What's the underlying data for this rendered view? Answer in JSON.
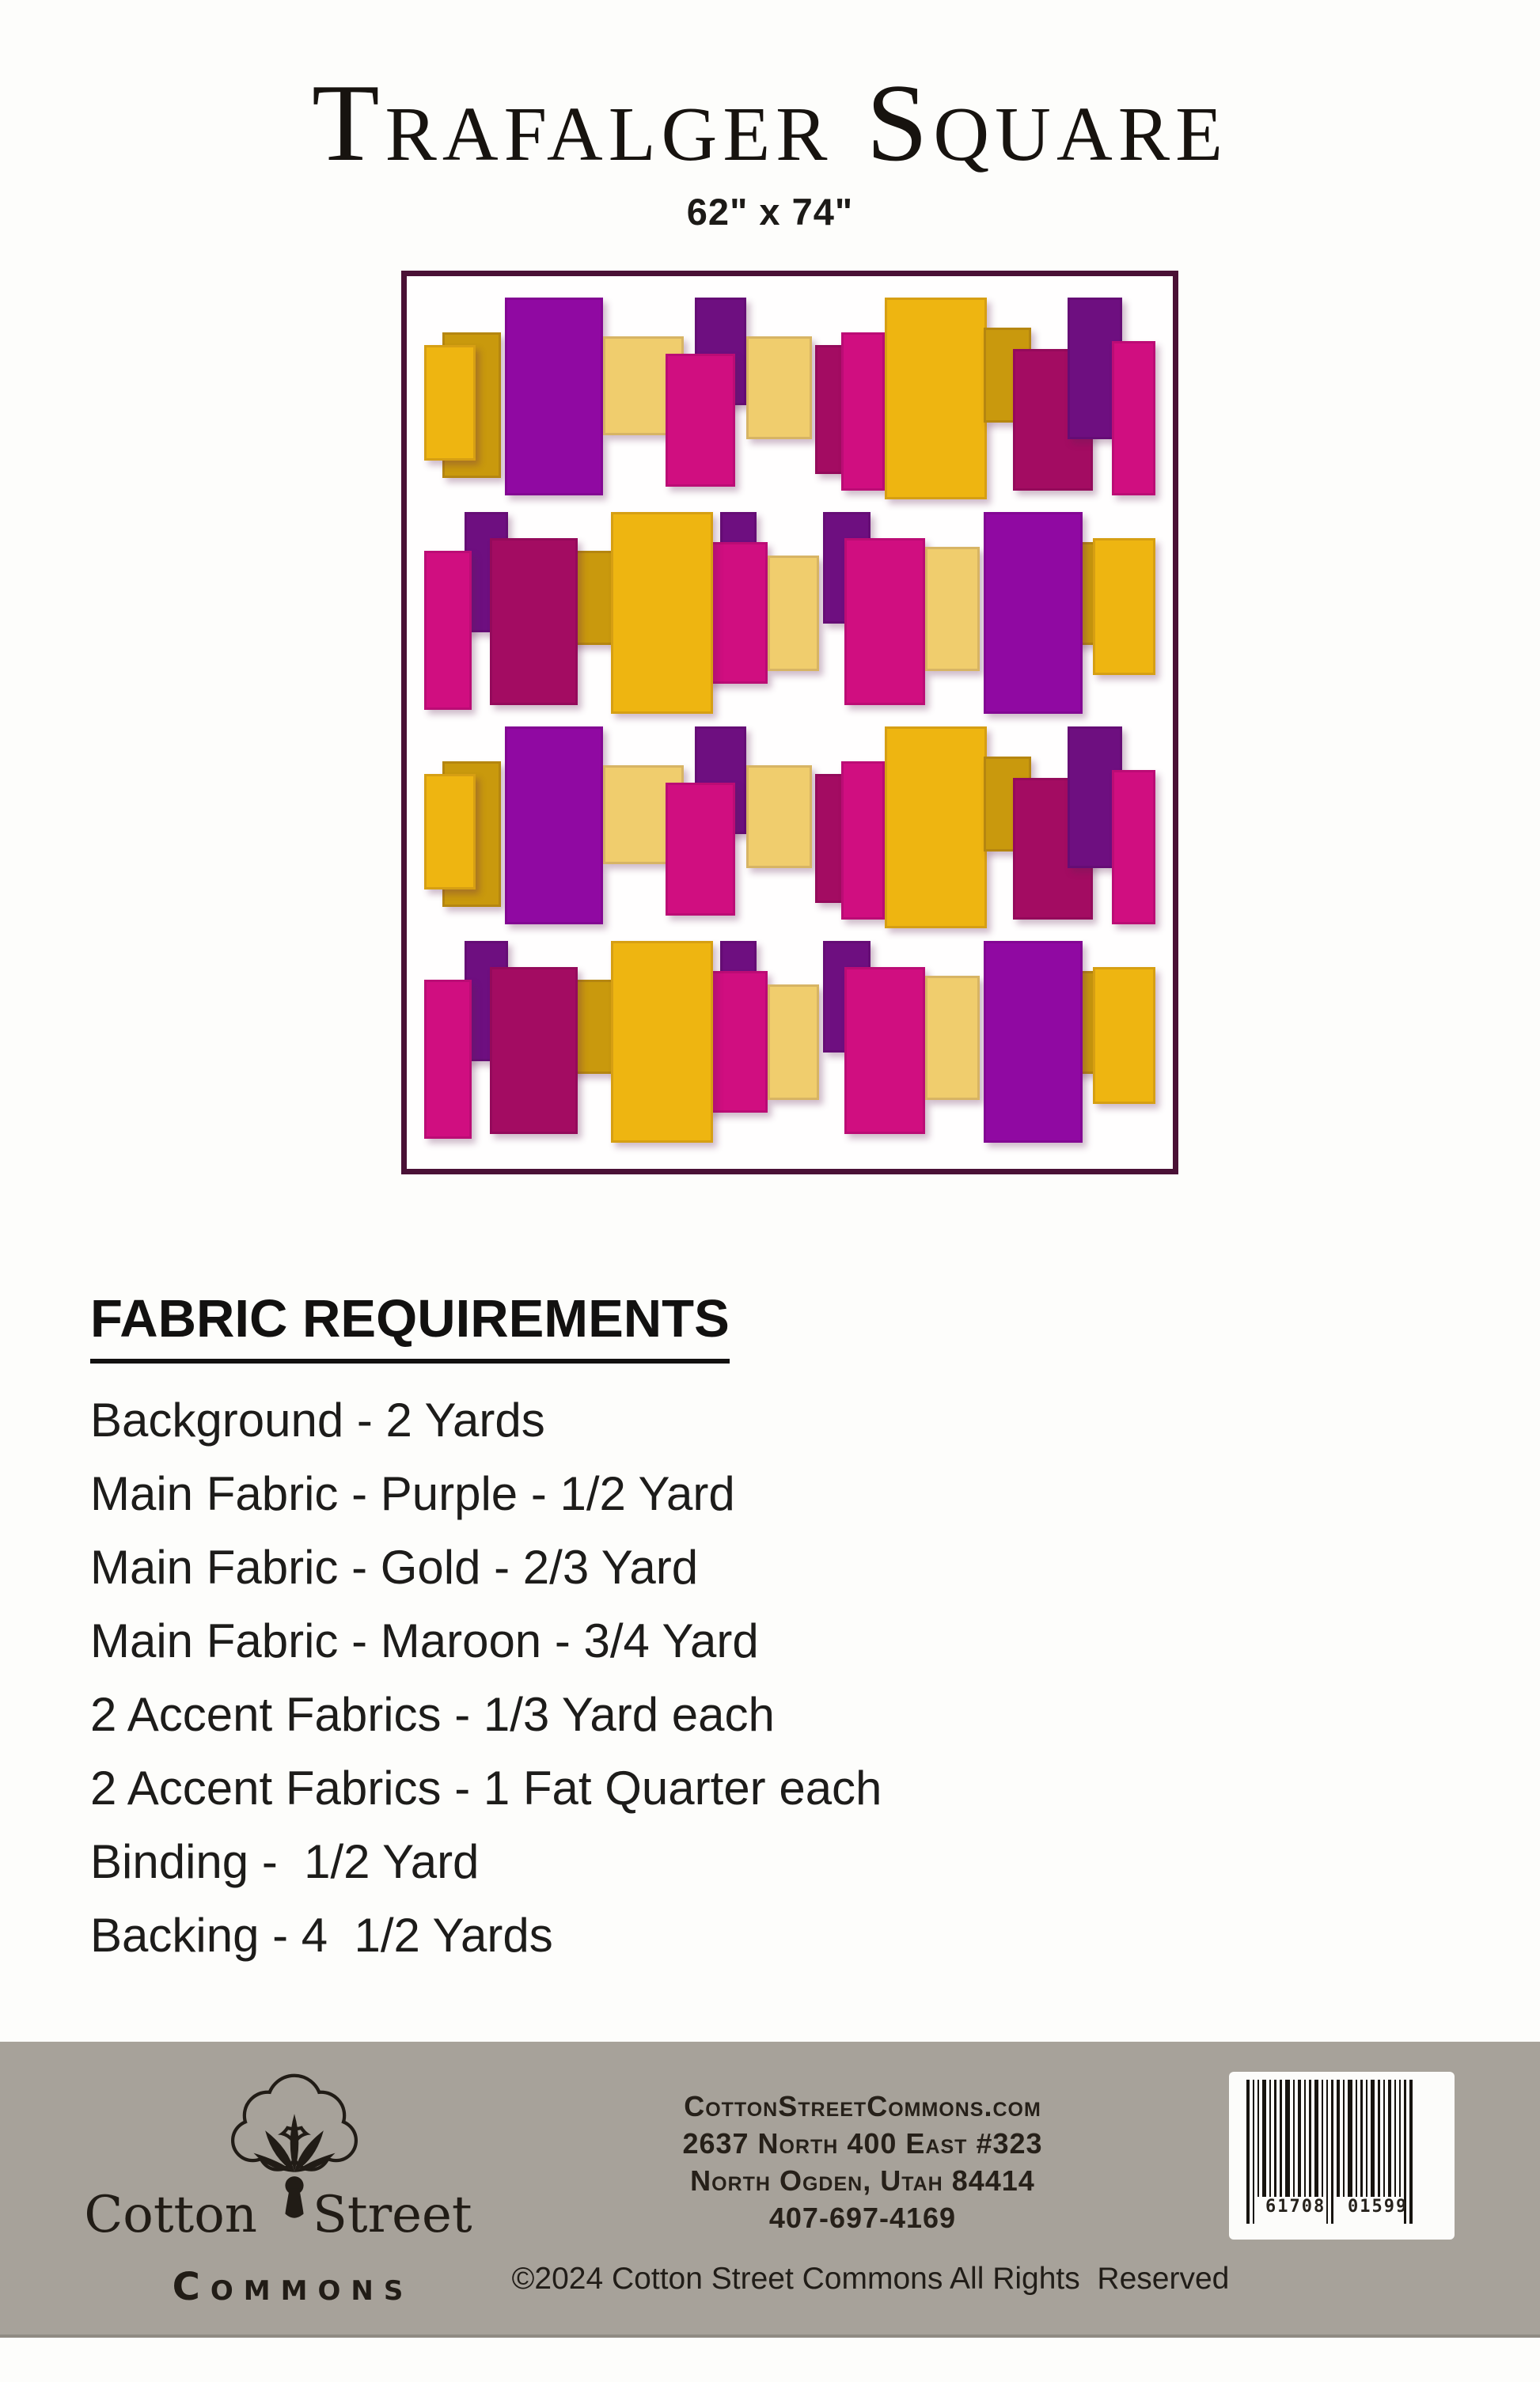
{
  "page": {
    "title": "Trafalger Square",
    "size_label": "62\" x 74\""
  },
  "quilt": {
    "border_color": "#4a1136",
    "colors": {
      "purple": "#9009a2",
      "darkpurple": "#6e0f80",
      "gold": "#eeb511",
      "olive": "#c9990d",
      "lightgold": "#f0cd6d",
      "magenta": "#d00e80",
      "maroon": "#a30c62"
    },
    "row_order": [
      "A",
      "B",
      "A",
      "B"
    ],
    "row_patterns": {
      "A": [
        [
          2.5,
          4.5,
          8,
          17,
          "olive"
        ],
        [
          0,
          6,
          7,
          13.5,
          "gold"
        ],
        [
          11,
          0.5,
          13.5,
          23,
          "purple"
        ],
        [
          24.5,
          5,
          11,
          11.5,
          "lightgold"
        ],
        [
          37,
          0.5,
          7,
          12.5,
          "darkpurple"
        ],
        [
          33,
          7,
          9.5,
          15.5,
          "magenta"
        ],
        [
          44,
          5,
          9,
          12,
          "lightgold"
        ],
        [
          53.5,
          6,
          5,
          15,
          "maroon"
        ],
        [
          57,
          4.5,
          6,
          18.5,
          "magenta"
        ],
        [
          63,
          0.5,
          14,
          23.5,
          "gold"
        ],
        [
          76.5,
          4,
          6.5,
          11,
          "olive"
        ],
        [
          80.5,
          6.5,
          11,
          16.5,
          "maroon"
        ],
        [
          88,
          0.5,
          7.5,
          16.5,
          "darkpurple"
        ],
        [
          94,
          5.5,
          6,
          18,
          "magenta"
        ]
      ],
      "B": [
        [
          5.5,
          0.5,
          6,
          14,
          "darkpurple"
        ],
        [
          0,
          5,
          6.5,
          18.5,
          "magenta"
        ],
        [
          19.5,
          5,
          6.5,
          11,
          "olive"
        ],
        [
          9,
          3.5,
          12,
          19.5,
          "maroon"
        ],
        [
          40.5,
          0.5,
          5,
          9,
          "darkpurple"
        ],
        [
          38.5,
          4,
          8.5,
          16.5,
          "magenta"
        ],
        [
          25.5,
          0.5,
          14,
          23.5,
          "gold"
        ],
        [
          47,
          5.5,
          7,
          13.5,
          "lightgold"
        ],
        [
          54.5,
          0.5,
          6.5,
          13,
          "darkpurple"
        ],
        [
          57.5,
          3.5,
          11,
          19.5,
          "magenta"
        ],
        [
          68.5,
          4.5,
          7.5,
          14.5,
          "lightgold"
        ],
        [
          88.5,
          4,
          6,
          12,
          "olive"
        ],
        [
          91.5,
          3.5,
          8.5,
          16,
          "gold"
        ],
        [
          76.5,
          0.5,
          13.5,
          23.5,
          "purple"
        ]
      ]
    }
  },
  "fabric_requirements": {
    "heading": "FABRIC REQUIREMENTS",
    "items": [
      "Background - 2 Yards",
      "Main Fabric - Purple - 1/2 Yard",
      "Main Fabric - Gold - 2/3 Yard",
      "Main Fabric - Maroon - 3/4 Yard",
      "2 Accent Fabrics - 1/3 Yard each",
      "2 Accent Fabrics - 1 Fat Quarter each",
      "Binding -  1/2 Yard",
      "Backing - 4  1/2 Yards"
    ]
  },
  "footer": {
    "bar_color": "#a7a29a",
    "logo": {
      "icon": "cotton-boll-icon",
      "word_left": "Cotton",
      "word_right": "Street",
      "word_bottom": "Commons"
    },
    "contact_lines": [
      "CottonStreetCommons.com",
      "2637 North 400 East #323",
      "North Ogden, Utah 84414",
      "407-697-4169"
    ],
    "copyright": "©2024 Cotton Street Commons All Rights  Reserved",
    "barcode": {
      "left_digits": "61708",
      "right_digits": "01599",
      "bars": [
        4,
        2,
        2,
        5,
        2,
        3,
        3,
        6,
        2,
        4,
        2,
        3,
        5,
        2,
        2,
        3,
        4,
        2,
        6,
        2,
        3,
        2,
        5,
        3,
        2,
        4,
        2,
        2,
        3,
        4
      ],
      "guard_indexes": [
        0,
        1,
        14,
        15,
        28,
        29
      ]
    }
  }
}
